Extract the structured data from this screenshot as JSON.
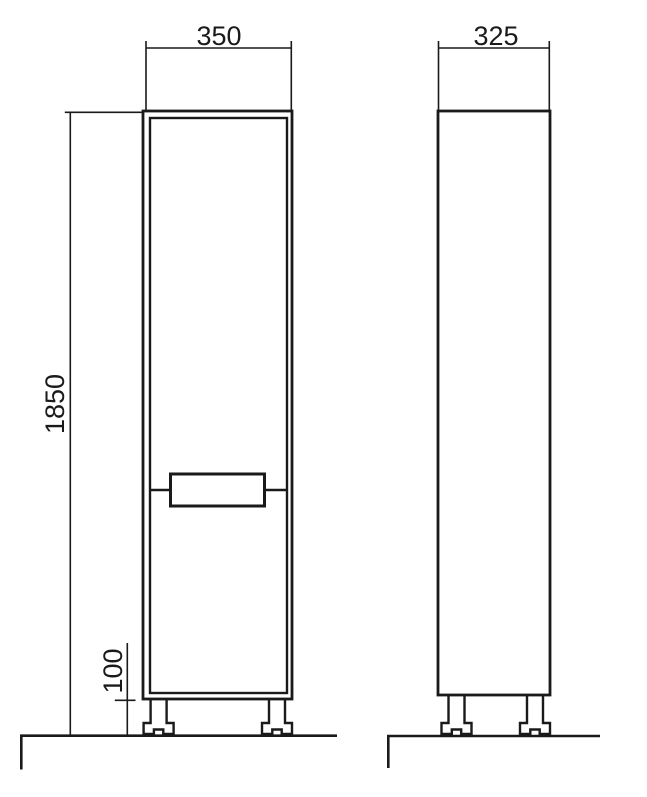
{
  "page": {
    "background": "#ffffff"
  },
  "drawing": {
    "kind": "furniture-technical-drawing",
    "views": [
      "front-elevation",
      "side-elevation"
    ],
    "line_color": "#1a1a1a",
    "dimensions": {
      "front_width": "350",
      "side_depth": "325",
      "total_height": "1850",
      "leg_height": "100"
    }
  }
}
